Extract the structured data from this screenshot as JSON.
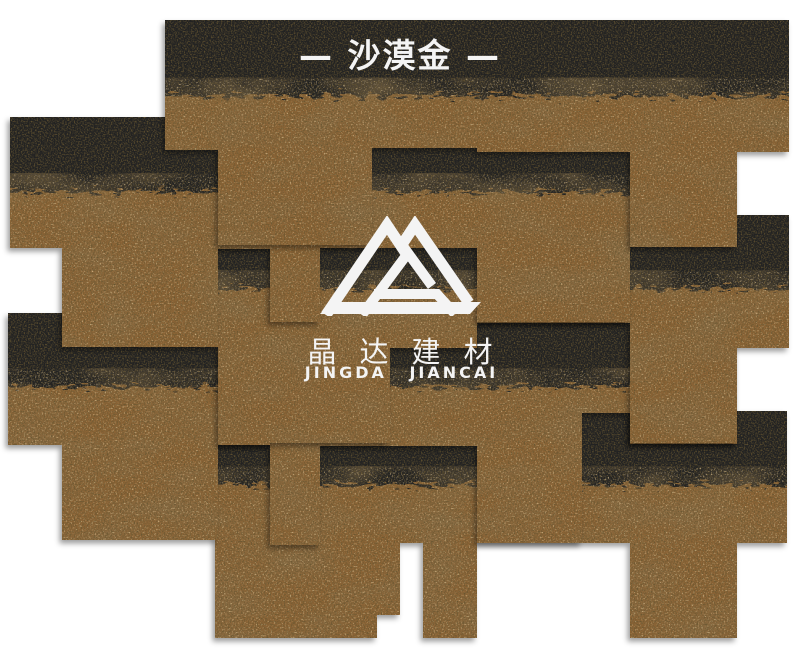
{
  "title": {
    "text": "— 沙漠金 —"
  },
  "brand": {
    "name_cn": "晶达建材",
    "name_en": "JINGDA JIANCAI"
  },
  "colors": {
    "background": "#ffffff",
    "granule-brown": "#8a6434",
    "granule-light": "#c99a55",
    "granule-dark": "#221708",
    "shingle-black": "#232120",
    "text-white": "#f4f4f4"
  }
}
